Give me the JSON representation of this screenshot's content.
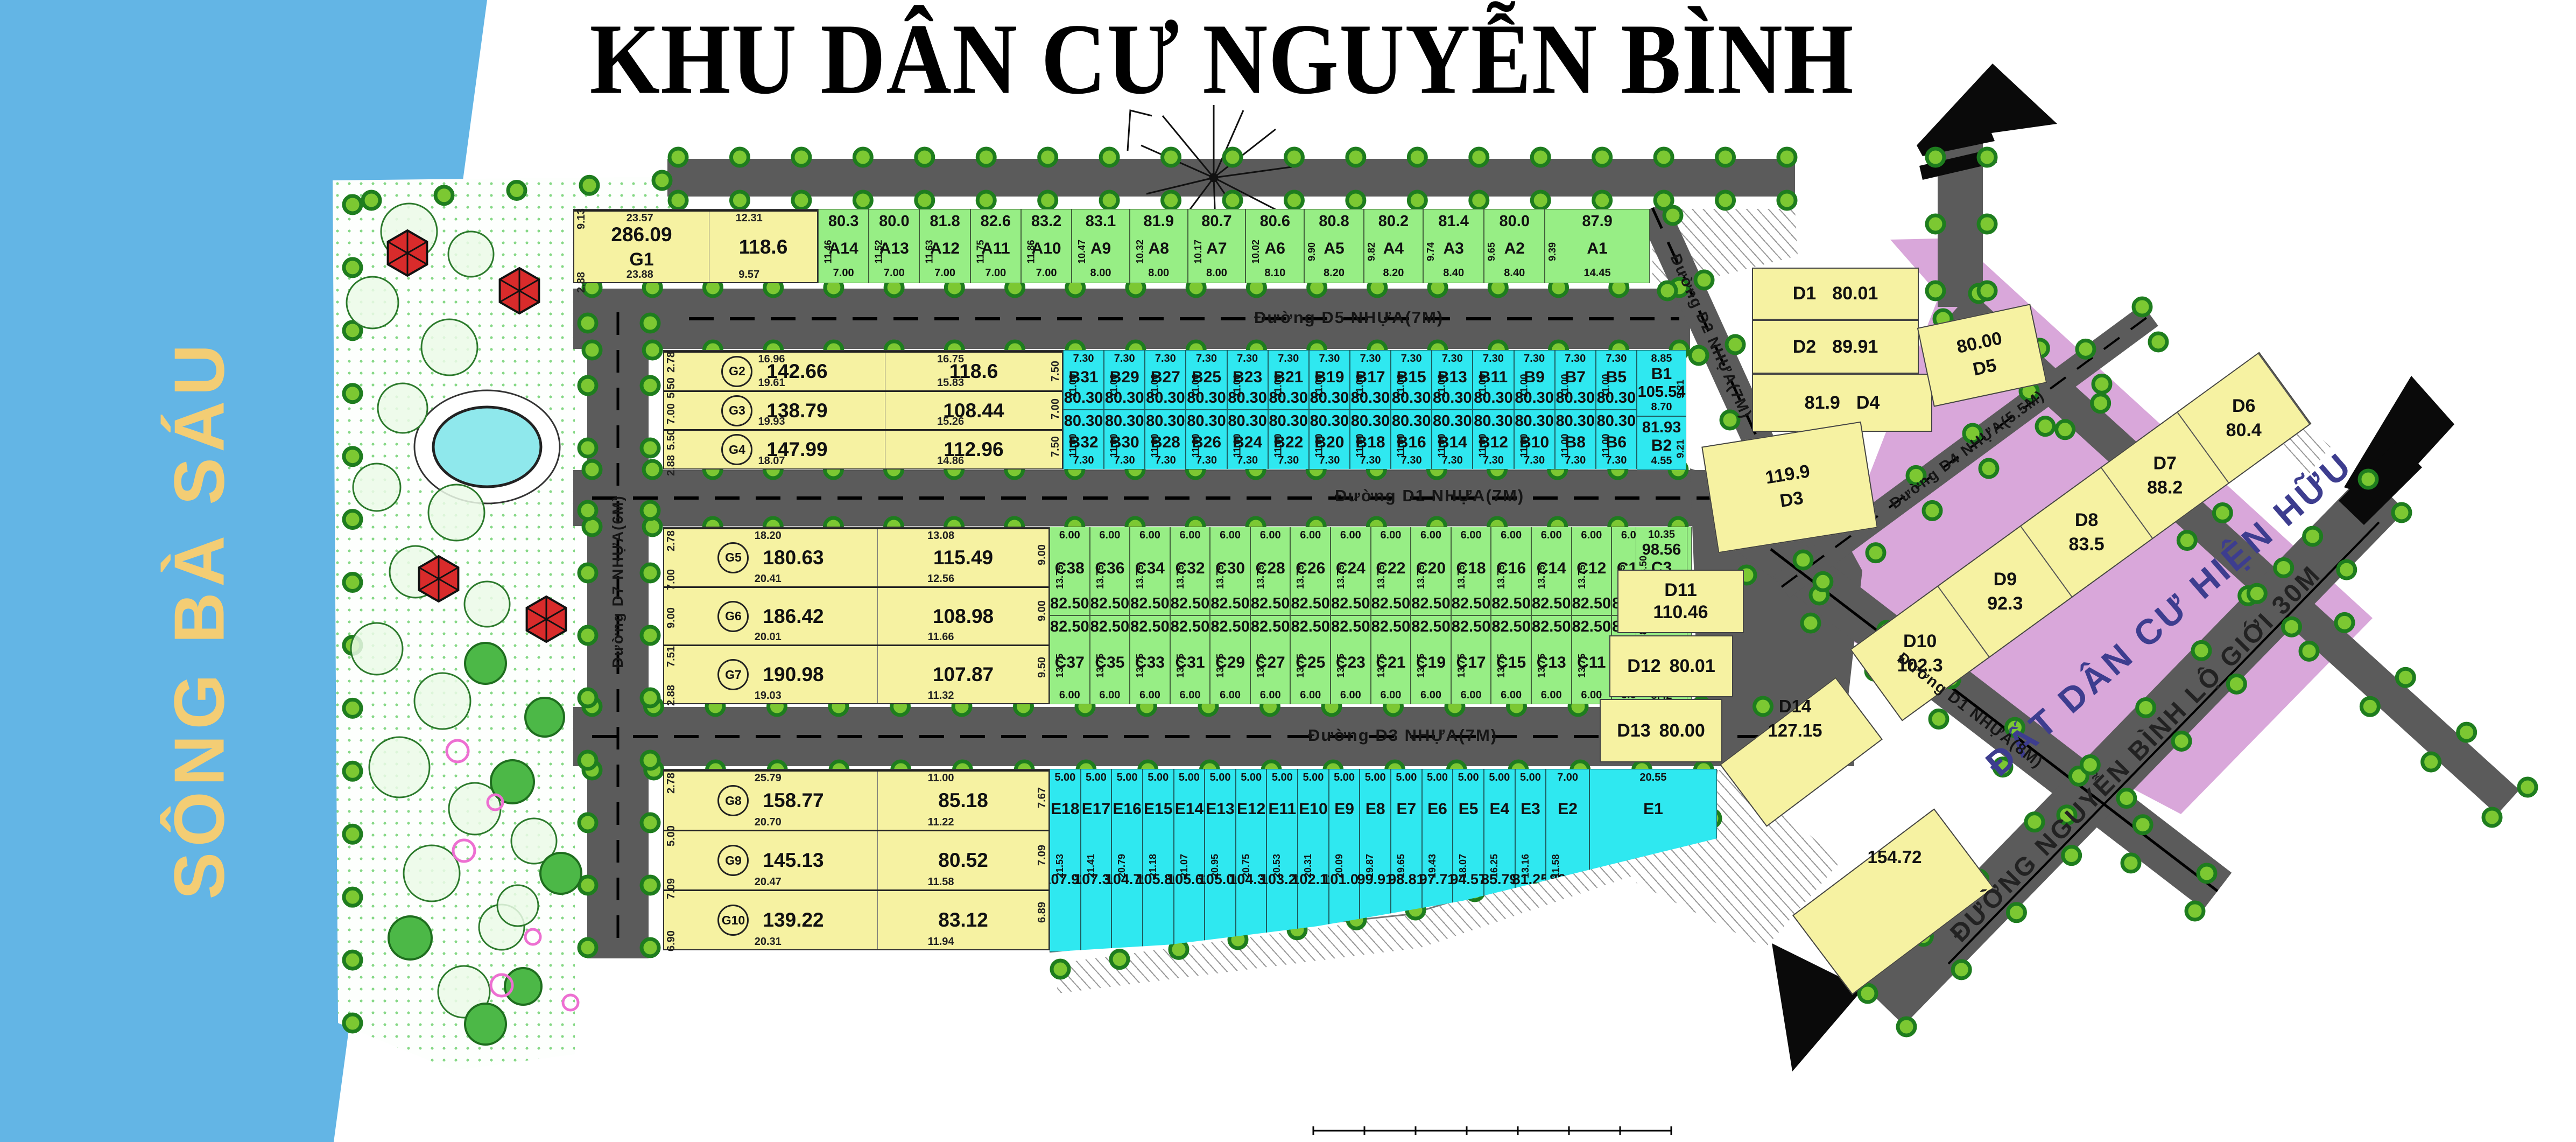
{
  "title": "KHU DÂN CƯ NGUYỄN BÌNH",
  "river": {
    "name": "SÔNG BÀ SÁU"
  },
  "existing_area_label": "ĐẤT DÂN CƯ HIỆN HỮU",
  "roads": {
    "d5": "Đường D5 NHỰA(7M)",
    "d1_7m": "Đường D1 NHỰA(7M)",
    "d3": "Đường D3 NHỰA(7M)",
    "d2": "Đường D2 NHỰA(7M)",
    "d4": "Đường D4 NHỰA(5.5M)",
    "d1_8m": "Đường D1 NHỰA(8M)",
    "d7": "Đường D7 NHỰA(6M)",
    "nguyen_binh": "ĐƯỜNG NGUYỄN BÌNH LỘ GIỚI 30M"
  },
  "band_a": {
    "lots": [
      {
        "id": "A14",
        "area": "80.3",
        "w": "7.00",
        "d": "11.46"
      },
      {
        "id": "A13",
        "area": "80.0",
        "w": "7.00",
        "d": "11.52"
      },
      {
        "id": "A12",
        "area": "81.8",
        "w": "7.00",
        "d": "11.63"
      },
      {
        "id": "A11",
        "area": "82.6",
        "w": "7.00",
        "d": "11.75"
      },
      {
        "id": "A10",
        "area": "83.2",
        "w": "7.00",
        "d": "11.86"
      },
      {
        "id": "A9",
        "area": "83.1",
        "w": "8.00",
        "d": "10.47"
      },
      {
        "id": "A8",
        "area": "81.9",
        "w": "8.00",
        "d": "10.32"
      },
      {
        "id": "A7",
        "area": "80.7",
        "w": "8.00",
        "d": "10.17"
      },
      {
        "id": "A6",
        "area": "80.6",
        "w": "8.10",
        "d": "10.02"
      },
      {
        "id": "A5",
        "area": "80.8",
        "w": "8.20",
        "d": "9.90"
      },
      {
        "id": "A4",
        "area": "80.2",
        "w": "8.20",
        "d": "9.82"
      },
      {
        "id": "A3",
        "area": "81.4",
        "w": "8.40",
        "d": "9.74"
      },
      {
        "id": "A2",
        "area": "80.0",
        "w": "8.40",
        "d": "9.65"
      },
      {
        "id": "A1",
        "area": "87.9",
        "w": "14.45",
        "d": "9.39"
      }
    ],
    "top_dims": [
      "1.5",
      "11.7",
      "1.42",
      "11.1",
      "1.35",
      "10.5",
      "1.27",
      "10.0",
      "1.19",
      "9.3",
      "1.09",
      "8.6",
      "1.00",
      "8.0",
      "0.92",
      "8.0",
      "0.96",
      "5.1"
    ],
    "corner_dims": [
      "8.25",
      "4.53"
    ]
  },
  "band_b": {
    "w": "7.30",
    "d": "11.00",
    "area": "80.30",
    "top_ids": [
      "B31",
      "B29",
      "B27",
      "B25",
      "B23",
      "B21",
      "B19",
      "B17",
      "B15",
      "B13",
      "B11",
      "B9",
      "B7",
      "B5"
    ],
    "bottom_ids": [
      "B32",
      "B30",
      "B28",
      "B26",
      "B24",
      "B22",
      "B20",
      "B18",
      "B16",
      "B14",
      "B12",
      "B10",
      "B8",
      "B6"
    ],
    "b1": {
      "id": "B1",
      "area": "105.54",
      "w": "8.85",
      "side": "9.21",
      "corner": "2.45",
      "split": "8.70"
    },
    "b2": {
      "id": "B2",
      "area": "81.93",
      "w": "4.55",
      "side": "9.21",
      "corner": "3.09"
    }
  },
  "band_c": {
    "w": "6.00",
    "d": "13.75",
    "area": "82.50",
    "top_ids": [
      "C38",
      "C36",
      "C34",
      "C32",
      "C30",
      "C28",
      "C26",
      "C24",
      "C22",
      "C20",
      "C18",
      "C16",
      "C14",
      "C12",
      "C10",
      "C8"
    ],
    "bottom_ids": [
      "C37",
      "C35",
      "C33",
      "C31",
      "C29",
      "C27",
      "C25",
      "C23",
      "C21",
      "C19",
      "C17",
      "C15",
      "C13",
      "C11",
      "C9",
      "C7"
    ],
    "c3": {
      "id": "C3",
      "area": "98.56",
      "t": "10.35",
      "b": "11.13",
      "side": "8.50",
      "right": "6.08",
      "corner": "3.19"
    },
    "c2": {
      "id": "C2",
      "area": "82.76",
      "b": "9.57",
      "side": "8.00",
      "right": "8.15"
    },
    "c1": {
      "id": "C1",
      "area": "91.47",
      "b": "5.42",
      "side": "11.00",
      "right": "9.21",
      "corner": "3.09"
    }
  },
  "band_e": {
    "lots": [
      {
        "id": "E18",
        "area": "107.92",
        "w": "5.00",
        "d": "21.53"
      },
      {
        "id": "E17",
        "area": "107.35",
        "w": "5.00",
        "d": "21.41"
      },
      {
        "id": "E16",
        "area": "104.79",
        "w": "5.00",
        "d": "20.79"
      },
      {
        "id": "E15",
        "area": "105.80",
        "w": "5.00",
        "d": "21.18"
      },
      {
        "id": "E14",
        "area": "105.63",
        "w": "5.00",
        "d": "21.07"
      },
      {
        "id": "E13",
        "area": "105.06",
        "w": "5.00",
        "d": "20.95"
      },
      {
        "id": "E12",
        "area": "104.30",
        "w": "5.00",
        "d": "20.75"
      },
      {
        "id": "E11",
        "area": "103.21",
        "w": "5.00",
        "d": "20.53"
      },
      {
        "id": "E10",
        "area": "102.11",
        "w": "5.00",
        "d": "20.31"
      },
      {
        "id": "E9",
        "area": "101.01",
        "w": "5.00",
        "d": "20.09"
      },
      {
        "id": "E8",
        "area": "99.91",
        "w": "5.00",
        "d": "19.87"
      },
      {
        "id": "E7",
        "area": "98.81",
        "w": "5.00",
        "d": "19.65"
      },
      {
        "id": "E6",
        "area": "97.71",
        "w": "5.00",
        "d": "19.43"
      },
      {
        "id": "E5",
        "area": "94.57",
        "w": "5.00",
        "d": "18.07"
      },
      {
        "id": "E4",
        "area": "85.79",
        "w": "5.00",
        "d": "16.25"
      },
      {
        "id": "E3",
        "area": "81.25",
        "w": "5.00",
        "d": "13.16"
      },
      {
        "id": "E2",
        "area": "86.88",
        "w": "7.00",
        "d": "11.58"
      },
      {
        "id": "E1",
        "area": "115.83",
        "w": "20.55",
        "d": ""
      }
    ],
    "edge_dim": "11.83"
  },
  "g1": {
    "rows": [
      {
        "id": "G1",
        "a1": "286.09",
        "a2": "118.6",
        "b1": "23.88",
        "b2": "9.57"
      }
    ],
    "top": [
      "23.57",
      "12.31"
    ],
    "left": [
      "9.13",
      "2.88"
    ],
    "right": []
  },
  "gb": {
    "rows": [
      {
        "id": "G2",
        "a1": "142.66",
        "a2": "118.6",
        "b1": "19.61",
        "b2": "15.83"
      },
      {
        "id": "G3",
        "a1": "138.79",
        "a2": "108.44",
        "b1": "19.93",
        "b2": "15.26"
      },
      {
        "id": "G4",
        "a1": "147.99",
        "a2": "112.96",
        "b1": "18.07",
        "b2": "14.86"
      }
    ],
    "top": [
      "16.96",
      "16.75"
    ],
    "left": [
      "2.78",
      "5.50",
      "7.00",
      "5.50",
      "2.88"
    ],
    "right": [
      "7.50",
      "7.00",
      "7.50"
    ]
  },
  "gc": {
    "rows": [
      {
        "id": "G5",
        "a1": "180.63",
        "a2": "115.49",
        "b1": "20.41",
        "b2": "12.56"
      },
      {
        "id": "G6",
        "a1": "186.42",
        "a2": "108.98",
        "b1": "20.01",
        "b2": "11.66"
      },
      {
        "id": "G7",
        "a1": "190.98",
        "a2": "107.87",
        "b1": "19.03",
        "b2": "11.32"
      }
    ],
    "top": [
      "18.20",
      "13.08"
    ],
    "left": [
      "2.78",
      "7.00",
      "9.00",
      "7.51",
      "2.88"
    ],
    "right": [
      "9.00",
      "9.00",
      "9.50"
    ]
  },
  "ge": {
    "rows": [
      {
        "id": "G8",
        "a1": "158.77",
        "a2": "85.18",
        "b1": "20.70",
        "b2": "11.22"
      },
      {
        "id": "G9",
        "a1": "145.13",
        "a2": "80.52",
        "b1": "20.47",
        "b2": "11.58"
      },
      {
        "id": "G10",
        "a1": "139.22",
        "a2": "83.12",
        "b1": "20.31",
        "b2": "11.94"
      }
    ],
    "top": [
      "25.79",
      "11.00"
    ],
    "left": [
      "2.78",
      "5.00",
      "7.09",
      "6.90"
    ],
    "right": [
      "7.67",
      "7.09",
      "6.89"
    ]
  },
  "d_lots": [
    {
      "id": "D1",
      "area": "80.01",
      "dims": [
        "12.42"
      ]
    },
    {
      "id": "D2",
      "area": "89.91",
      "dims": [
        "12.42",
        "7.17",
        "12.54",
        "5.81"
      ]
    },
    {
      "id": "D3",
      "area": "119.9",
      "dims": [
        "9.49",
        "14.52",
        "4.50",
        "2.74"
      ]
    },
    {
      "id": "D4",
      "area": "81.9",
      "dims": [
        "14.61",
        "14.61",
        "6.81",
        "5.59"
      ]
    },
    {
      "id": "D5",
      "area": "80.00",
      "dims": [
        "14.71",
        "14.36"
      ]
    },
    {
      "id": "D6",
      "area": "80.4",
      "dims": [
        "11.62",
        "2.21"
      ]
    },
    {
      "id": "D7",
      "area": "88.2",
      "dims": [
        "7.50",
        "5.36"
      ]
    },
    {
      "id": "D8",
      "area": "83.5",
      "dims": [
        "7.50",
        "11.49",
        "7.53"
      ]
    },
    {
      "id": "D9",
      "area": "92.3",
      "dims": [
        "9.00",
        "10.78",
        "9.04"
      ]
    },
    {
      "id": "D10",
      "area": "102.3",
      "dims": [
        "9.12",
        "9.63",
        "6.97",
        "5.11",
        "5.97",
        "2.74"
      ]
    },
    {
      "id": "D11",
      "area": "110.46",
      "dims": [
        "3.36",
        "12.31",
        "10.18",
        "3.08"
      ]
    },
    {
      "id": "D12",
      "area": "80.01",
      "dims": [
        "10.81",
        "2.34",
        "3.36",
        "7.83",
        "4.56"
      ]
    },
    {
      "id": "D13",
      "area": "80.00",
      "dims": [
        "10.04",
        "2.25",
        "11.54",
        "4.50",
        "9.60"
      ]
    },
    {
      "id": "D14",
      "area": "127.15",
      "dims": [
        "3.36",
        "2.24",
        "3.46",
        "3.30",
        "14.12",
        "10.17"
      ]
    }
  ],
  "extra_lot": {
    "area": "154.72",
    "dims": [
      "8.34",
      "10.17",
      "14.21",
      "18.43",
      "2.72",
      "7.16"
    ]
  },
  "colors": {
    "green": "#97EE85",
    "cyan": "#2FE8F0",
    "yellow": "#F6F2A2",
    "purple": "#D9A7DA",
    "road": "#5B5B5B",
    "river": "#63B5E5",
    "river_text": "#F3CD74",
    "tree_fill": "#7CC832",
    "tree_ring": "#1E7D1E",
    "gazebo": "#D92B2B",
    "pond": "#8FE8EC",
    "pink": "#ED6FD1"
  }
}
